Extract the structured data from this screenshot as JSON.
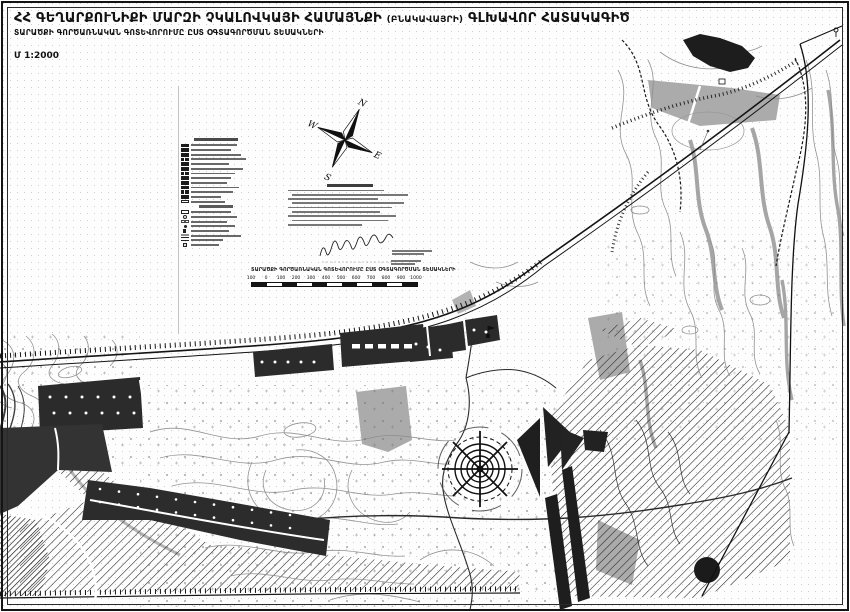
{
  "document": {
    "title_main": "ՀՀ ԳԵՂԱՐՔՈՒՆԻՔԻ ՄԱՐԶԻ ՉԿԱԼՈՎԿԱՅԻ ՀԱՄԱՅՆՔԻ",
    "title_paren": "(ԲՆԱԿԱՎԱՅՐԻ)",
    "title_tail": "ԳԼԽԱՎՈՐ ՀԱՏԱԿԱԳԻԾ",
    "subtitle": "ՏԱՐԱԾՔԻ ԳՈՐԾԱՌՆԱԿԱՆ ԳՈՏԵՎՈՐՈՒՄԸ ԸՍՏ ՕԳՏԱԳՈՐԾՄԱՆ ՏԵՍԱԿՆԵՐԻ",
    "scale_label": "Մ 1:2000"
  },
  "compass": {
    "n": "N",
    "e": "E",
    "s": "S",
    "w": "W"
  },
  "legend": {
    "section1": [
      {
        "swatch": "s",
        "w": 46
      },
      {
        "swatch": "s",
        "w": 40
      },
      {
        "swatch": "s",
        "w": 50
      },
      {
        "swatch": "sw",
        "w": 55
      },
      {
        "swatch": "s",
        "w": 38
      },
      {
        "swatch": "s",
        "w": 52
      },
      {
        "swatch": "sw",
        "w": 44
      },
      {
        "swatch": "s",
        "w": 40
      },
      {
        "swatch": "s",
        "w": 36
      },
      {
        "swatch": "s",
        "w": 48
      },
      {
        "swatch": "sw",
        "w": 42
      },
      {
        "swatch": "s",
        "w": 30
      },
      {
        "swatch": "x",
        "w": 34
      }
    ],
    "section2": [
      {
        "swatch": "o",
        "w": 40
      },
      {
        "swatch": "ci",
        "w": 46
      },
      {
        "swatch": "sl",
        "w": 36
      },
      {
        "swatch": "dt",
        "w": 44
      },
      {
        "swatch": "fl",
        "w": 38
      },
      {
        "swatch": "hb",
        "w": 50
      },
      {
        "swatch": "ln",
        "w": 32
      },
      {
        "swatch": "sq",
        "w": 28
      }
    ]
  },
  "notes": {
    "line_widths": [
      96,
      116,
      90,
      112,
      104,
      88,
      108,
      96,
      74
    ]
  },
  "signature_note_widths": [
    40,
    32
  ],
  "scalebar": {
    "caption": "ՏԱՐԱԾՔԻ ԳՈՐԾԱՌՆԱԿԱՆ ԳՈՏԵՎՈՐՈՒՄԸ ԸՍՏ ՕԳՏԱԳՈՐԾՄԱՆ ՏԵՍԱԿՆԵՐԻ",
    "ticks": [
      "100",
      "0",
      "100",
      "200",
      "300",
      "400",
      "500",
      "600",
      "700",
      "800",
      "900",
      "1000"
    ],
    "segments": 11,
    "side_note_widths": [
      30,
      24
    ]
  },
  "colors": {
    "ink": "#111111",
    "contour_gray": "#8d8d8d",
    "zone_gray": "#ababab",
    "block_dark": "#2b2b2b"
  }
}
